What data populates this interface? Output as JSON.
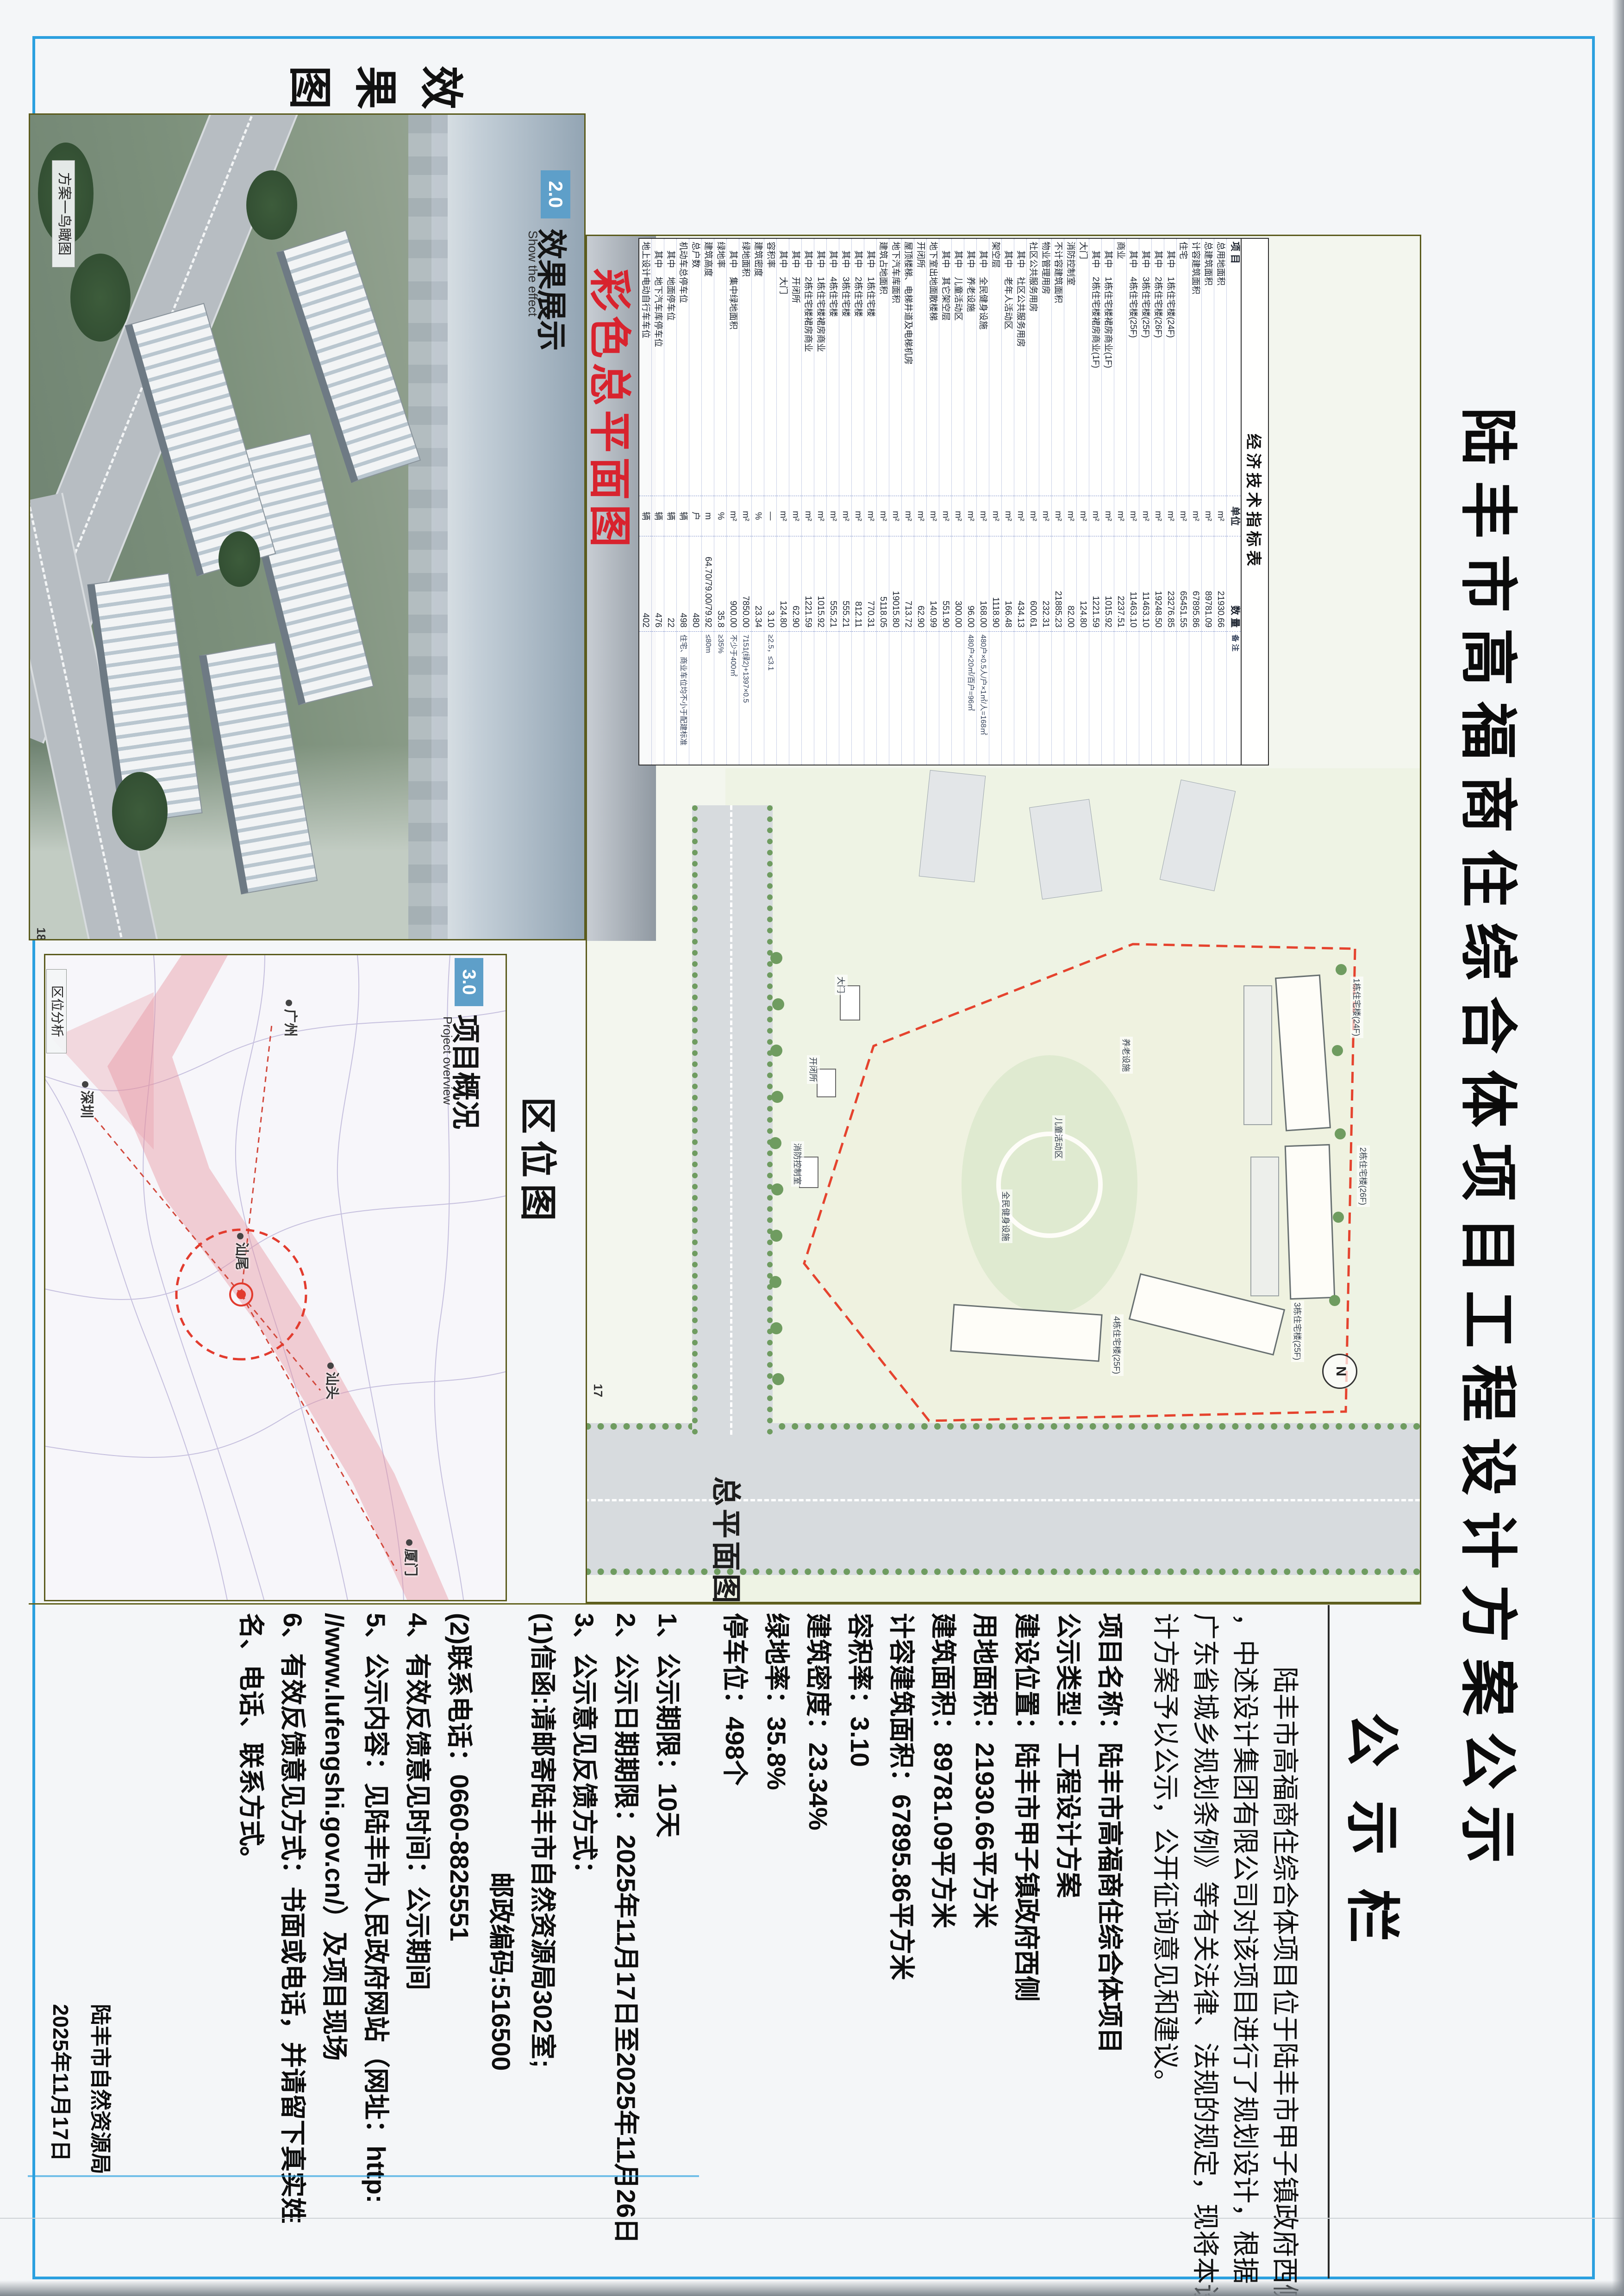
{
  "title": "陆丰市高福商住综合体项目工程设计方案公示",
  "board_label": "公示栏",
  "margin_label": "效果图",
  "panels": {
    "render": {
      "header_no": "2.0",
      "header_cn": "效果展示",
      "header_en": "Show the effect",
      "caption": "方案一鸟瞰图",
      "page_no": "18"
    },
    "master_plan": {
      "banner": "彩色总平面图",
      "big_label": "总平面图",
      "page_no": "17",
      "north": "N"
    },
    "location": {
      "header_no": "3.0",
      "header_cn": "项目概况",
      "header_en": "Project overview",
      "caption": "区位分析",
      "big_label": "区位图"
    }
  },
  "notice": {
    "intro_lines": [
      "　　陆丰市高福商住综合体项目位于陆丰市甲子镇政府西侧",
      "，中述设计集团有限公司对该项目进行了规划设计，根据《",
      "广东省城乡规划条例》等有关法律、法规的规定，现将本设",
      "计方案予以公示，公开征询意见和建议。"
    ],
    "detail_lines": [
      {
        "text": "项目名称：陆丰市高福商住综合体项目",
        "cls": "ln"
      },
      {
        "text": "公示类型：工程设计方案",
        "cls": "ln"
      },
      {
        "text": "建设位置：陆丰市甲子镇政府西侧",
        "cls": "ln"
      },
      {
        "text": "用地面积：21930.66平方米",
        "cls": "ln"
      },
      {
        "text": "建筑面积：89781.09平方米",
        "cls": "ln"
      },
      {
        "text": "计容建筑面积：67895.86平方米",
        "cls": "ln"
      },
      {
        "text": "容积率：3.10",
        "cls": "ln"
      },
      {
        "text": "建筑密度：23.34%",
        "cls": "ln"
      },
      {
        "text": "绿地率：35.8%",
        "cls": "ln"
      },
      {
        "text": "停车位：498个",
        "cls": "ln"
      },
      {
        "text": "1、公示期限：10天",
        "cls": "ln gap"
      },
      {
        "text": "2、公示日期期限：2025年11月17日至2025年11月26日",
        "cls": "ln"
      },
      {
        "text": "3、公示意见反馈方式：",
        "cls": "ln"
      },
      {
        "text": "(1)信函:请邮寄陆丰市自然资源局302室;",
        "cls": "ln"
      },
      {
        "text": "邮政编码:516500",
        "cls": "ln ind"
      },
      {
        "text": "(2)联系电话：0660-8825551",
        "cls": "ln"
      },
      {
        "text": "4、有效反馈意见时间：公示期间",
        "cls": "ln"
      },
      {
        "text": "5、公示内容：见陆丰市人民政府网站（网址：http:",
        "cls": "ln"
      },
      {
        "text": "//www.lufengshi.gov.cn/）及项目现场",
        "cls": "ln"
      },
      {
        "text": "6、有效反馈意见方式：书面或电话，并请留下真实姓",
        "cls": "ln"
      },
      {
        "text": "名、电话、联系方式。",
        "cls": "ln"
      }
    ]
  },
  "signature": {
    "org": "陆丰市自然资源局",
    "date": "2025年11月17日"
  },
  "map_cities": [
    {
      "name": "广州",
      "style": "left:96px;top:440px"
    },
    {
      "name": "深圳",
      "style": "left:272px;top:880px"
    },
    {
      "name": "汕尾",
      "style": "left:600px;top:545px"
    },
    {
      "name": "汕头",
      "style": "left:880px;top:350px"
    },
    {
      "name": "厦门",
      "style": "left:1262px;top:180px"
    }
  ],
  "plan_labels": [
    {
      "text": "1栋住宅楼(24F)",
      "style": "left:1600px;top:122px"
    },
    {
      "text": "2栋住宅楼(26F)",
      "style": "left:1965px;top:108px"
    },
    {
      "text": "3栋住宅楼(25F)",
      "style": "left:2300px;top:250px"
    },
    {
      "text": "4栋住宅楼(25F)",
      "style": "left:2330px;top:640px"
    },
    {
      "text": "养老设施",
      "style": "left:1730px;top:620px"
    },
    {
      "text": "儿童活动区",
      "style": "left:1900px;top:766px"
    },
    {
      "text": "全民健身设施",
      "style": "left:2060px;top:880px"
    },
    {
      "text": "大门",
      "style": "left:1596px;top:1236px"
    },
    {
      "text": "开闭所",
      "style": "left:1770px;top:1296px"
    },
    {
      "text": "消防控制室",
      "style": "left:1956px;top:1330px"
    }
  ],
  "chart_data": {
    "type": "table",
    "title": "经济技术指标表",
    "columns": [
      "项 目",
      "单位",
      "数 量",
      "备 注"
    ],
    "rows": [
      [
        "总用地面积",
        "m²",
        "21930.66",
        ""
      ],
      [
        "总建筑面积",
        "m²",
        "89781.09",
        ""
      ],
      [
        "计容建筑面积",
        "m²",
        "67895.86",
        ""
      ],
      [
        "住宅",
        "m²",
        "65451.55",
        ""
      ],
      [
        "　其中　1栋住宅楼(24F)",
        "m²",
        "23276.85",
        ""
      ],
      [
        "　其中　2栋住宅楼(26F)",
        "m²",
        "19248.50",
        ""
      ],
      [
        "　其中　3栋住宅楼(25F)",
        "m²",
        "11463.10",
        ""
      ],
      [
        "　其中　4栋住宅楼(25F)",
        "m²",
        "11463.10",
        ""
      ],
      [
        "商业",
        "m²",
        "2237.51",
        ""
      ],
      [
        "　其中　1栋住宅楼裙房商业(1F)",
        "m²",
        "1015.92",
        ""
      ],
      [
        "　其中　2栋住宅楼裙房商业(1F)",
        "m²",
        "1221.59",
        ""
      ],
      [
        "大门",
        "m²",
        "124.80",
        ""
      ],
      [
        "消防控制室",
        "m²",
        "82.00",
        ""
      ],
      [
        "不计容建筑面积",
        "m²",
        "21885.23",
        ""
      ],
      [
        "物业管理用房",
        "m²",
        "232.31",
        ""
      ],
      [
        "社区公共服务用房",
        "m²",
        "600.61",
        ""
      ],
      [
        "　其中　社区公共服务用房",
        "m²",
        "434.13",
        ""
      ],
      [
        "　其中　老年人活动区",
        "m²",
        "166.48",
        ""
      ],
      [
        "架空层",
        "m²",
        "1118.90",
        ""
      ],
      [
        "　其中　全民健身设施",
        "m²",
        "168.00",
        "480户×0.5人/户×1㎡/人=168㎡"
      ],
      [
        "　其中　养老设施",
        "m²",
        "96.00",
        "480户×20㎡/百户=96㎡"
      ],
      [
        "　其中　儿童活动区",
        "m²",
        "300.00",
        ""
      ],
      [
        "　其中　其它架空层",
        "m²",
        "551.90",
        ""
      ],
      [
        "地下室出地面散楼梯",
        "m²",
        "140.99",
        ""
      ],
      [
        "开闭所",
        "m²",
        "62.90",
        ""
      ],
      [
        "屋顶楼梯、电梯井道及电梯机房",
        "m²",
        "713.72",
        ""
      ],
      [
        "地下汽车库面积",
        "m²",
        "19015.80",
        ""
      ],
      [
        "建筑占地面积",
        "m²",
        "5118.05",
        ""
      ],
      [
        "　其中　1栋住宅楼",
        "m²",
        "770.31",
        ""
      ],
      [
        "　其中　2栋住宅楼",
        "m²",
        "812.11",
        ""
      ],
      [
        "　其中　3栋住宅楼",
        "m²",
        "555.21",
        ""
      ],
      [
        "　其中　4栋住宅楼",
        "m²",
        "555.21",
        ""
      ],
      [
        "　其中　1栋住宅楼裙房商业",
        "m²",
        "1015.92",
        ""
      ],
      [
        "　其中　2栋住宅楼裙房商业",
        "m²",
        "1221.59",
        ""
      ],
      [
        "　其中　开闭所",
        "m²",
        "62.90",
        ""
      ],
      [
        "　其中　大门",
        "m²",
        "124.80",
        ""
      ],
      [
        "容积率",
        "—",
        "3.10",
        "≥2.5，≤3.1"
      ],
      [
        "建筑密度",
        "%",
        "23.34",
        ""
      ],
      [
        "绿地面积",
        "m²",
        "7850.00",
        "7151(绿2)+1397×0.5"
      ],
      [
        "　其中　集中绿地面积",
        "m²",
        "900.00",
        "不少于400㎡"
      ],
      [
        "绿地率",
        "%",
        "35.8",
        "≥35%"
      ],
      [
        "建筑高度",
        "m",
        "64.70/79.00/79.92",
        "≤80m"
      ],
      [
        "总户数",
        "户",
        "480",
        ""
      ],
      [
        "机动车总停车位",
        "辆",
        "498",
        "住宅、商业车位均不小于配建标准"
      ],
      [
        "　其中　地面停车位",
        "辆",
        "22",
        ""
      ],
      [
        "　其中　地下汽车库停车位",
        "辆",
        "476",
        ""
      ],
      [
        "地上设计电动自行车车位",
        "辆",
        "402",
        ""
      ]
    ]
  }
}
